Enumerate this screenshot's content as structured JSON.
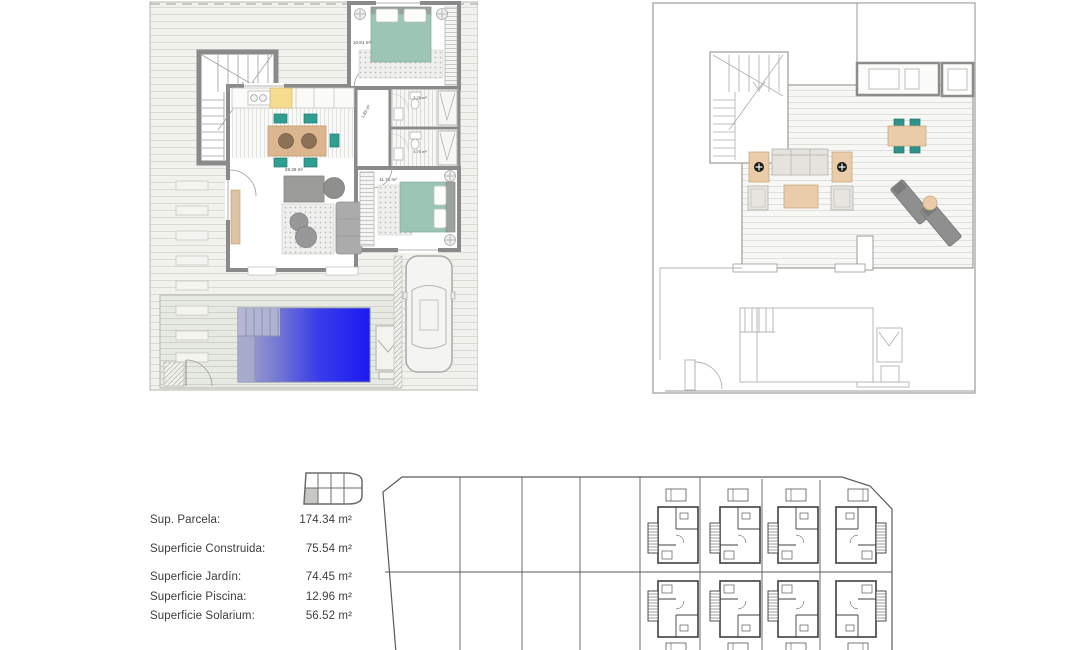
{
  "page": {
    "background": "#ffffff"
  },
  "plans": {
    "ground_floor": {
      "labels": {
        "living_kitchen": "28.36 m²",
        "hall": "1.83 m²",
        "bedroom_top": "10.81 m²",
        "bathroom_top": "3.75 m²",
        "bathroom_bottom": "3.75 m²",
        "bedroom_right": "11.71 m²"
      }
    }
  },
  "measurements": {
    "rows": [
      {
        "label": "Sup. Parcela:",
        "value": "174.34 m²"
      },
      {
        "label": "Superficie Construida:",
        "value": "75.54 m²"
      },
      {
        "label": "Superficie Jardín:",
        "value": "74.45 m²"
      },
      {
        "label": "Superficie Piscina:",
        "value": "12.96 m²"
      },
      {
        "label": "Superficie Solarium:",
        "value": "56.52 m²"
      }
    ]
  },
  "locator": {
    "grid_cols": 4,
    "grid_rows": 2,
    "highlighted_cell": "bottom-left"
  },
  "colors": {
    "wall_gray": "#8a8a8a",
    "bed_teal": "#9dc5b5",
    "chair_teal": "#2f9e93",
    "wood_tan": "#dcb68f",
    "terrace_tan": "#eacda8",
    "kitchen_yellow": "#f6dc8e",
    "pool_blue_left": "#a6aacb",
    "pool_blue_right": "#1a1af3",
    "sofa_gray": "#ababab",
    "site_line": "#3f3f3d"
  }
}
